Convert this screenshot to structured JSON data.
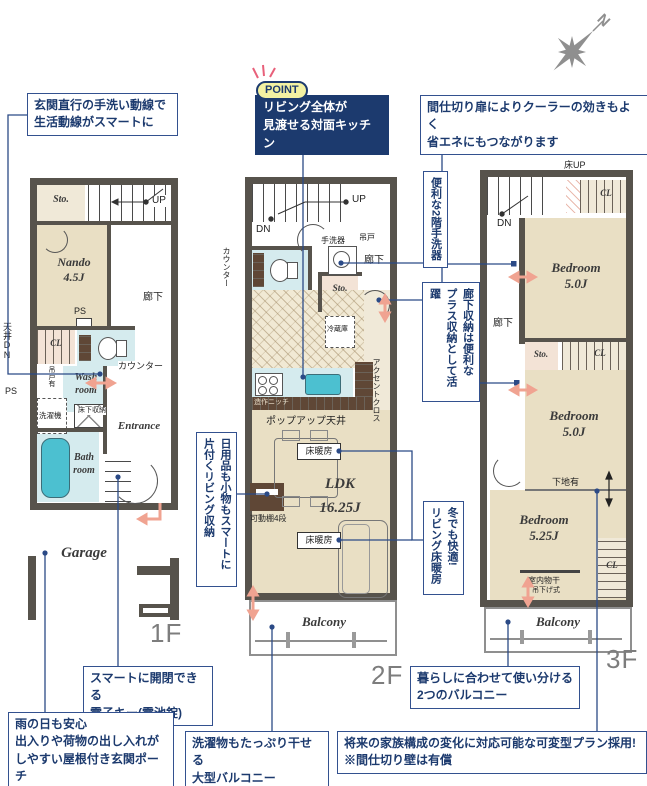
{
  "compass": {
    "north": "N"
  },
  "callouts": {
    "entry_flow": "玄関直行の手洗い動線で\n生活動線がスマートに",
    "point_badge": "POINT",
    "point_text": "リビング全体が\n見渡せる対面キッチン",
    "partition_door": "間仕切り扉によりクーラーの効きもよく\n省エネにもつながります",
    "handwash_2f": "便利な2階手洗器",
    "hallway_storage": "廊下収納は便利な\nプラス収納として活躍",
    "living_storage": "日用品も小物もスマートに\n片付くリビング収納",
    "floor_heating": "冬でも快適!\nリビング床暖房",
    "smart_key": "スマートに開閉できる\n電子キー(電池錠)",
    "roofed_porch": "雨の日も安心\n出入りや荷物の出し入れが\nしやすい屋根付き玄関ポーチ",
    "large_balcony": "洗濯物もたっぷり干せる\n大型バルコニー",
    "two_balconies": "暮らしに合わせて使い分ける\n2つのバルコニー",
    "flexible_plan": "将来の家族構成の変化に対応可能な可変型プラン採用!\n※間仕切り壁は有償"
  },
  "floor1": {
    "label": "1F",
    "rooms": {
      "storage": "Sto.",
      "nando": "Nando\n4.5J",
      "wash": "Wash\nroom",
      "bath": "Bath\nroom",
      "entrance": "Entrance",
      "garage": "Garage",
      "closet": "CL"
    },
    "labels": {
      "up": "UP",
      "hallway": "廊下",
      "ps": "PS",
      "ceiling_dn": "天井DN",
      "counter": "カウンター",
      "hanging_door": "吊戸有",
      "washer": "洗濯機",
      "underfloor_storage": "床下収納"
    }
  },
  "floor2": {
    "label": "2F",
    "rooms": {
      "ldk": "LDK\n16.25J",
      "storage": "Sto.",
      "balcony": "Balcony"
    },
    "labels": {
      "up": "UP",
      "dn": "DN",
      "handwash": "手洗器",
      "hanging_cupboard": "吊戸",
      "hallway": "廊下",
      "counter": "カウンター",
      "fridge": "冷蔵庫",
      "accent_cloth": "アクセントクロス",
      "niche": "造作ニッチ",
      "popup_ceiling": "ポップアップ天井",
      "floor_heating": "床暖房",
      "movable_shelf": "可動棚4段"
    }
  },
  "floor3": {
    "label": "3F",
    "rooms": {
      "bedroom_5_0": "Bedroom\n5.0J",
      "bedroom_5_25": "Bedroom\n5.25J",
      "storage": "Sto.",
      "balcony": "Balcony",
      "closet": "CL"
    },
    "labels": {
      "floor_up": "床UP",
      "dn": "DN",
      "hallway": "廊下",
      "base_wall": "下地有",
      "indoor_drying": "室内物干",
      "hanging_type": "吊下げ式"
    }
  }
}
